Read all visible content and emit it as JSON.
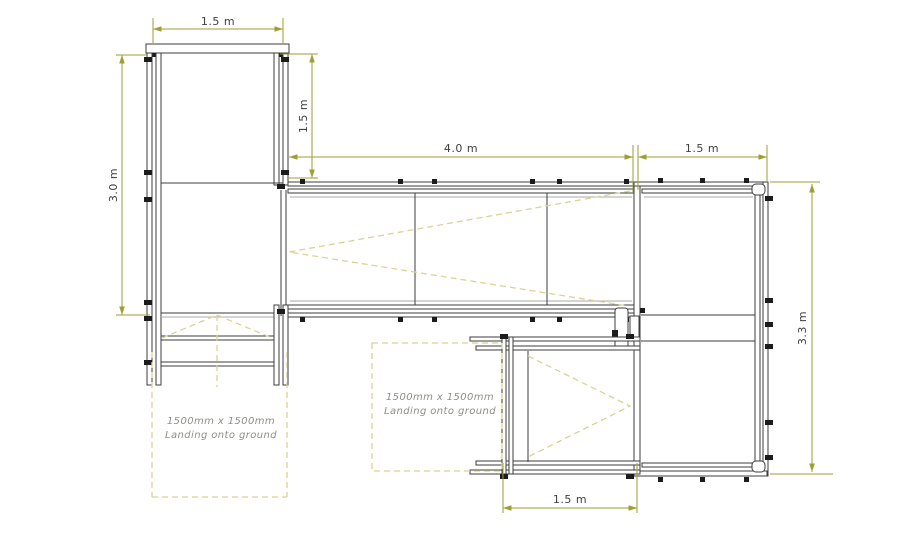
{
  "diagram": {
    "type": "modular-ramp-plan-drawing",
    "colors": {
      "background": "#ffffff",
      "structure_line": "#3d3d3d",
      "deck_line": "#a9a9a9",
      "dimension_line": "#9e9e33",
      "dimension_text": "#3f3f3f",
      "dashed_guide": "#d8d494",
      "note_text": "#8f8f86"
    },
    "dimensions": {
      "top_platform_width": "1.5 m",
      "left_structure_height": "3.0 m",
      "top_platform_depth": "1.5 m",
      "main_ramp_length": "4.0 m",
      "right_platform_width": "1.5 m",
      "right_platform_height": "3.3 m",
      "lower_ramp_length": "1.5 m"
    },
    "notes": {
      "left_landing": {
        "line1": "1500mm x 1500mm",
        "line2": "Landing onto ground"
      },
      "right_landing": {
        "line1": "1500mm x 1500mm",
        "line2": "Landing onto ground"
      }
    }
  }
}
